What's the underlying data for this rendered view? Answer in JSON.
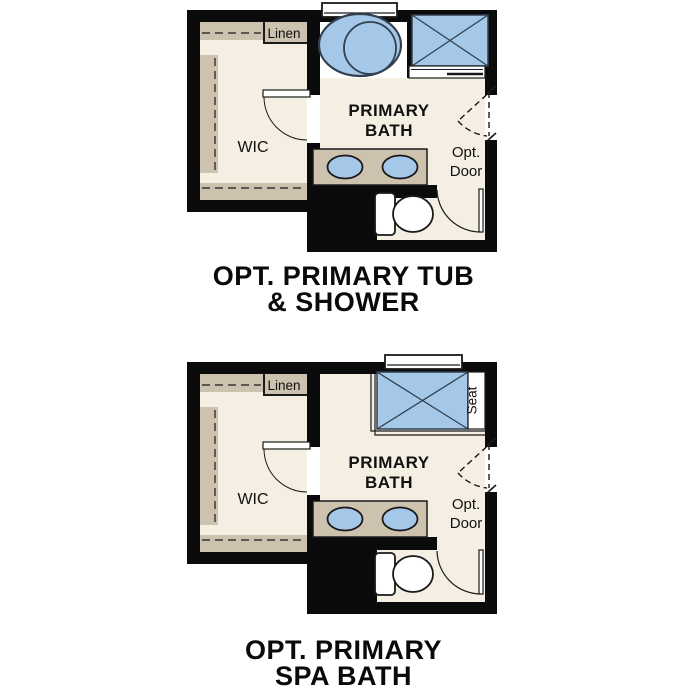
{
  "colors": {
    "bg": "#ffffff",
    "wall": "#0b0b0b",
    "floor": "#f4efe2",
    "shelf": "#ccc2ae",
    "fixture": "#a6c8e8",
    "fixture-outline": "#31404f",
    "line": "#1a1a1a",
    "text": "#111111"
  },
  "plans": [
    {
      "id": "opt-primary-tub-shower",
      "title_line1": "OPT. PRIMARY TUB",
      "title_line2": "& SHOWER",
      "labels": {
        "linen": "Linen",
        "wic": "WIC",
        "room_line1": "PRIMARY",
        "room_line2": "BATH",
        "opt_door_line1": "Opt.",
        "opt_door_line2": "Door"
      }
    },
    {
      "id": "opt-primary-spa-bath",
      "title_line1": "OPT. PRIMARY",
      "title_line2": "SPA BATH",
      "labels": {
        "linen": "Linen",
        "wic": "WIC",
        "room_line1": "PRIMARY",
        "room_line2": "BATH",
        "opt_door_line1": "Opt.",
        "opt_door_line2": "Door",
        "seat": "Seat"
      }
    }
  ]
}
